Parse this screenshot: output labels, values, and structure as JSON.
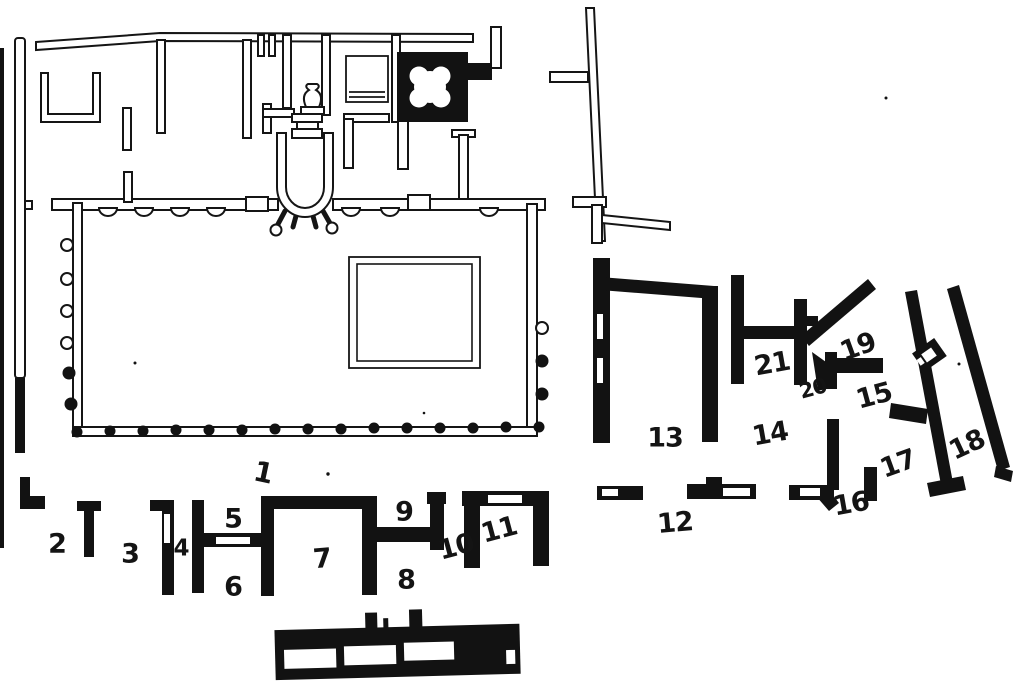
{
  "plan": {
    "type": "archaeological-floor-plan",
    "paper_color": "#ffffff",
    "ink_color": "#151515",
    "room_labels": [
      {
        "text": "1"
      },
      {
        "text": "2"
      },
      {
        "text": "3"
      },
      {
        "text": "4"
      },
      {
        "text": "5"
      },
      {
        "text": "6"
      },
      {
        "text": "7"
      },
      {
        "text": "8"
      },
      {
        "text": "9"
      },
      {
        "text": "10"
      },
      {
        "text": "11"
      },
      {
        "text": "12"
      },
      {
        "text": "13"
      },
      {
        "text": "14"
      },
      {
        "text": "15"
      },
      {
        "text": "16"
      },
      {
        "text": "17"
      },
      {
        "text": "18"
      },
      {
        "text": "19"
      },
      {
        "text": "20"
      },
      {
        "text": "21"
      }
    ]
  }
}
